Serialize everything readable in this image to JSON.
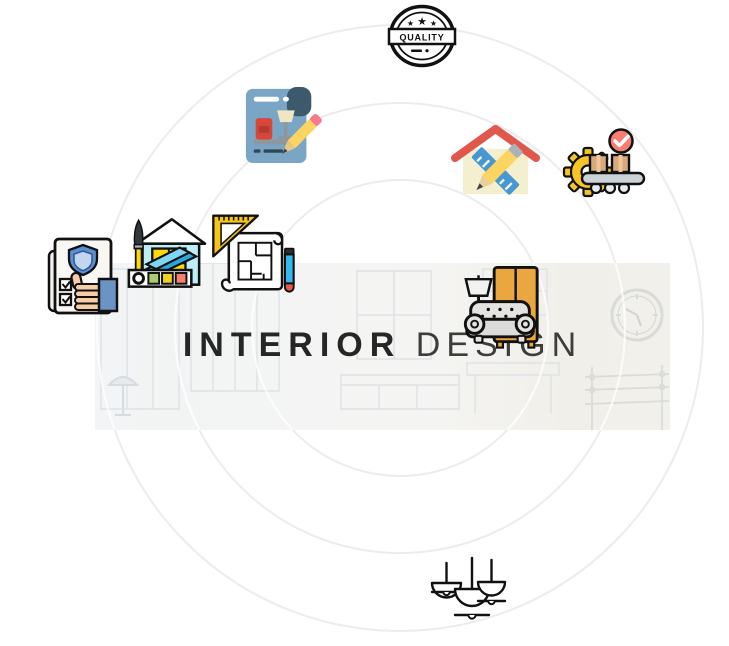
{
  "page": {
    "width": 729,
    "height": 646,
    "background": "#ffffff"
  },
  "decor": {
    "circle_color": "#ececec",
    "banner_background": "#f3f4f2",
    "ink": "#111111",
    "accent_red": "#e2574c",
    "accent_yellow": "#f6c525",
    "accent_blue": "#4797d2",
    "accent_tan": "#eba73f",
    "accent_paper_blue": "#7aa5c4"
  },
  "badge": {
    "label": "QUALITY",
    "stars": [
      "★",
      "★",
      "★"
    ]
  },
  "title": {
    "primary": "INTERIOR",
    "secondary": "DESIGN"
  },
  "icons": {
    "quality_stamp": "round quality seal with three stars",
    "furniture_sketch": "blue sheet with armchair, floor lamp and pencil",
    "home_design_tools": "house with crossed ruler and pencil",
    "production_line": "gear conveyor with boxes and check mark",
    "quality_checklist": "document with shield, checkboxes and thumbs-up",
    "home_decor": "house with paintbrush and color swatches",
    "blueprint": "floor-plan scroll with set square and pencil",
    "living_room": "armchair with wardrobe and floor lamp",
    "pendant_lamps": "three hanging dome lamps"
  },
  "background_sketch": [
    "window frames",
    "kitchen counter",
    "wall clock",
    "shelf rack",
    "floor lamp"
  ]
}
